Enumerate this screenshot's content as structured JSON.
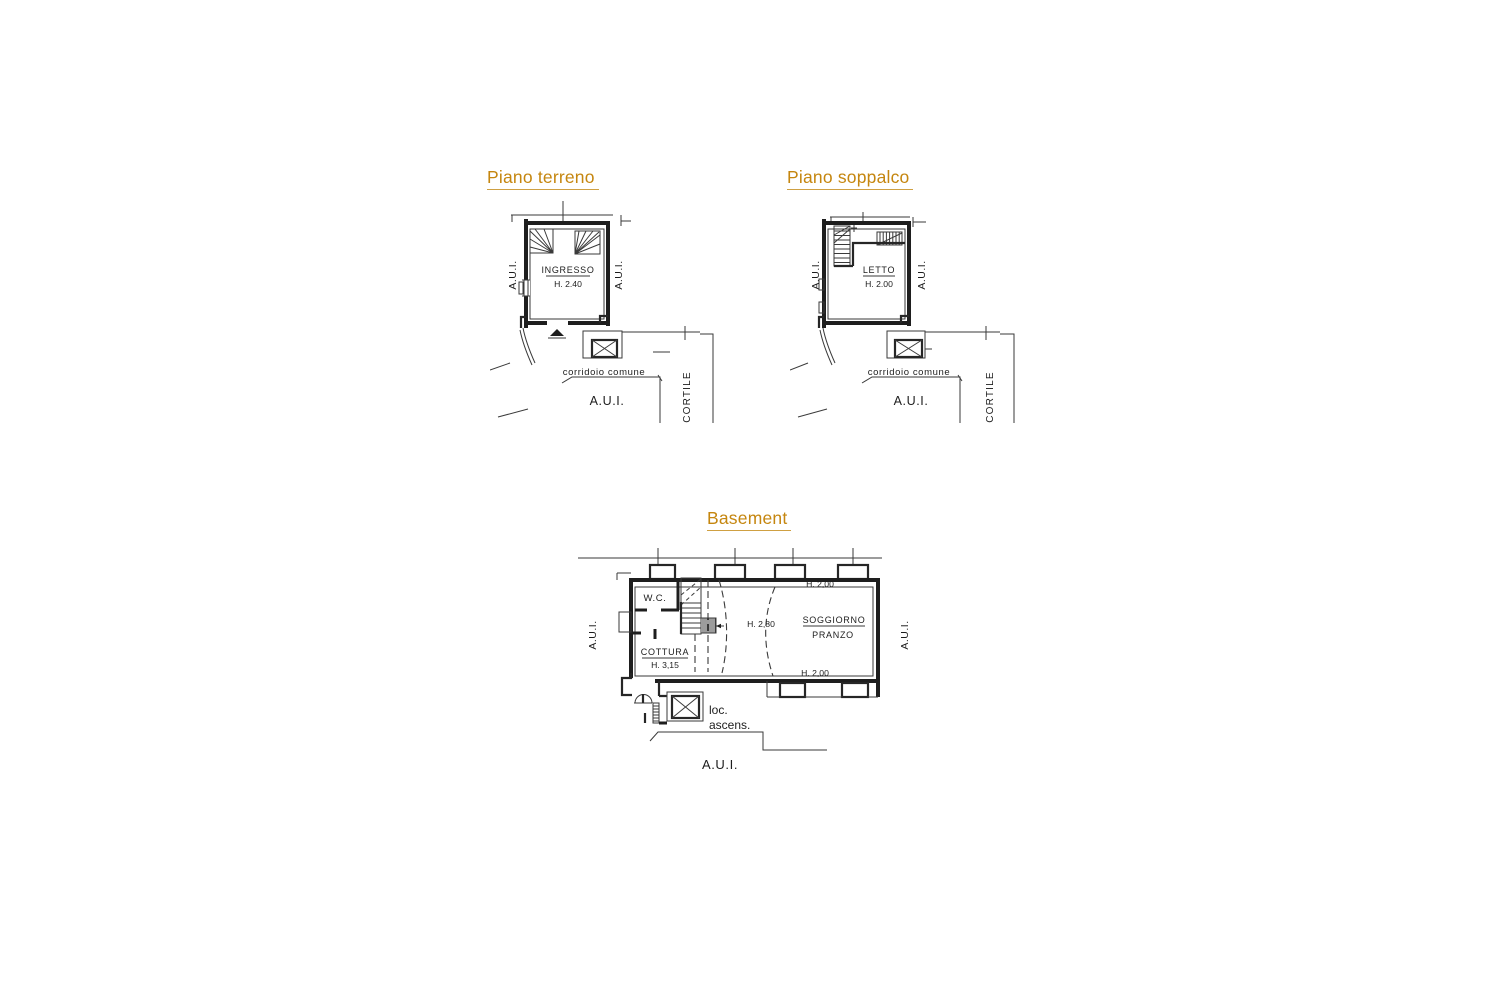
{
  "page": {
    "background": "#ffffff"
  },
  "colors": {
    "accent": "#c5860f",
    "ink": "#262626"
  },
  "plans": {
    "terreno": {
      "title": "Piano terreno",
      "room": {
        "name": "INGRESSO",
        "height": "H. 2.40"
      },
      "side_left": "A.U.I.",
      "side_right": "A.U.I.",
      "corridor": "corridoio comune",
      "area_below": "A.U.I.",
      "courtyard": "CORTILE"
    },
    "soppalco": {
      "title": "Piano soppalco",
      "room": {
        "name": "LETTO",
        "height": "H. 2.00"
      },
      "side_left": "A.U.I.",
      "side_right": "A.U.I.",
      "corridor": "corridoio comune",
      "area_below": "A.U.I.",
      "courtyard": "CORTILE"
    },
    "basement": {
      "title": "Basement",
      "wc": "W.C.",
      "kitchen": {
        "name": "COTTURA",
        "height": "H. 3,15"
      },
      "living": {
        "name": "SOGGIORNO",
        "name2": "PRANZO"
      },
      "h_top": "H. 2,00",
      "h_mid": "H. 2,80",
      "h_bottom": "H. 2,00",
      "side_left": "A.U.I.",
      "side_right": "A.U.I.",
      "area_below": "A.U.I.",
      "elevator": {
        "line1": "loc.",
        "line2": "ascens."
      }
    }
  }
}
